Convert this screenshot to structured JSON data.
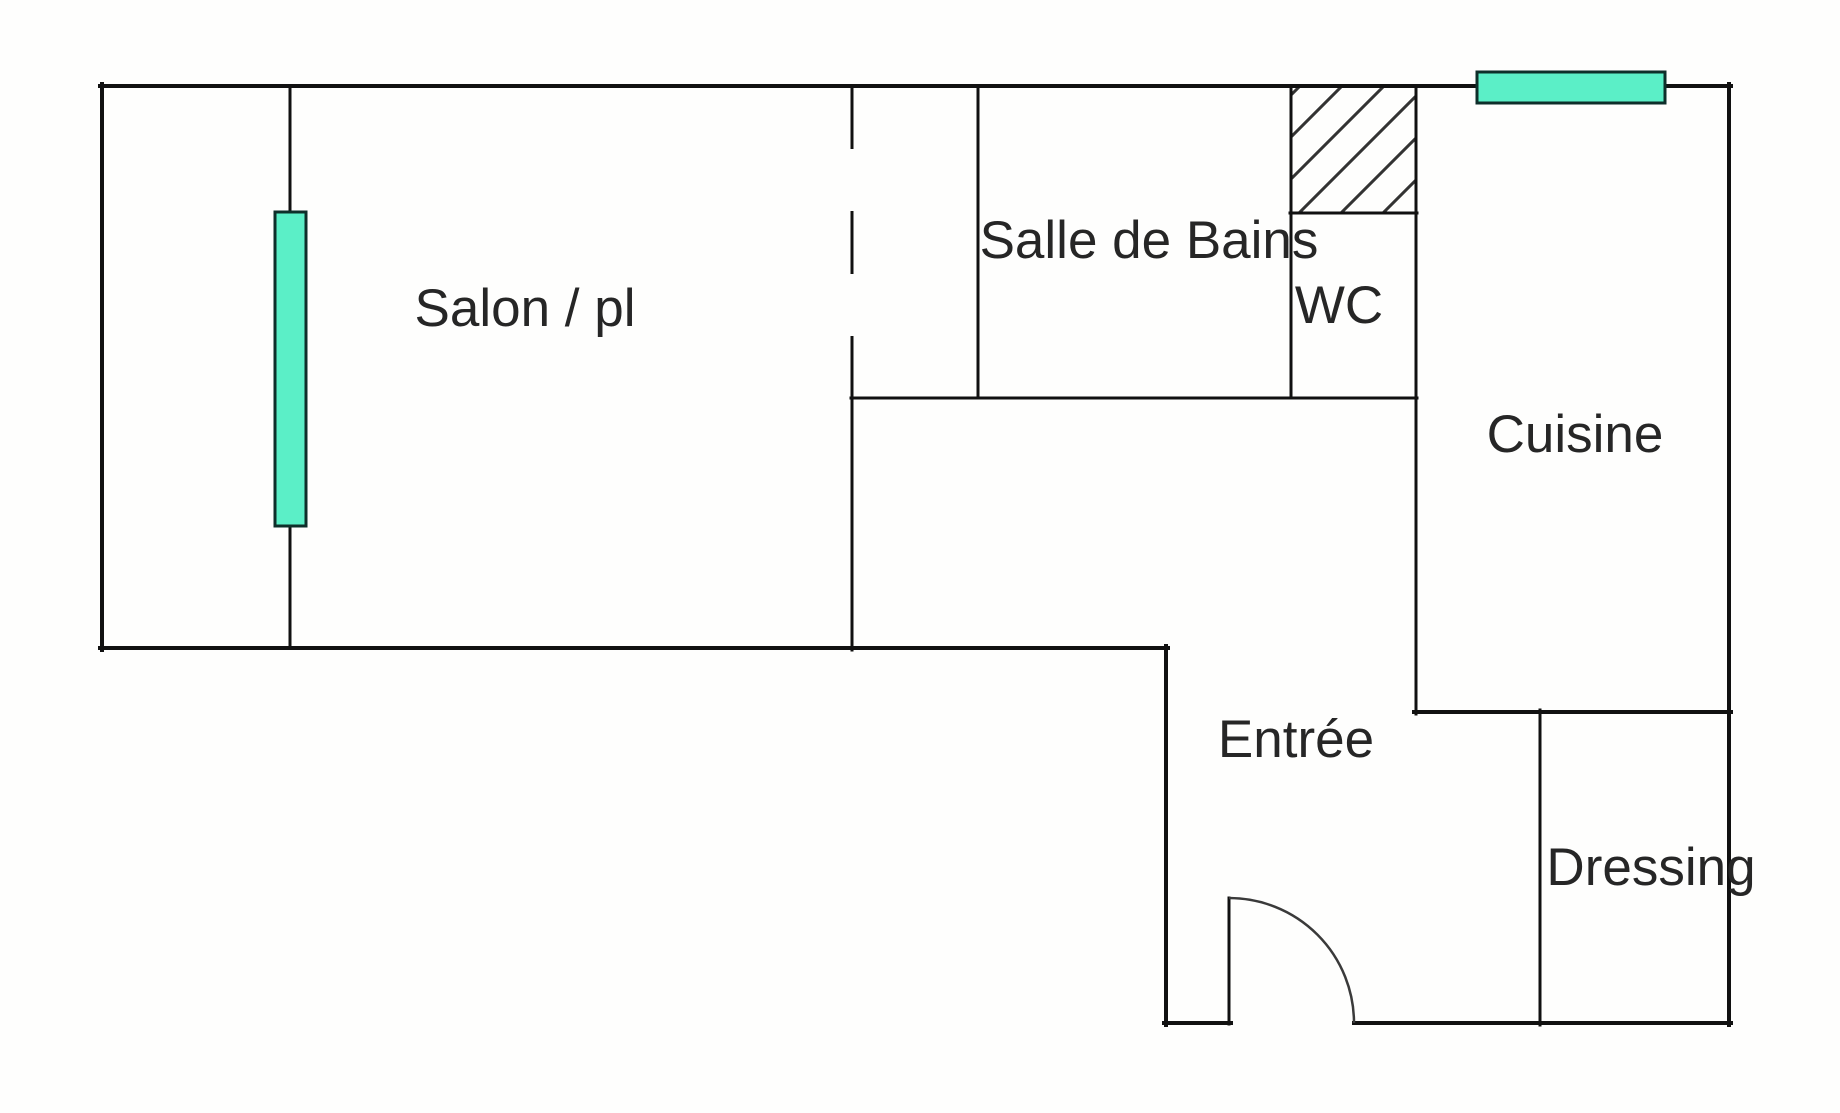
{
  "rooms": {
    "salon": {
      "label": "Salon / pl"
    },
    "salle_de_bains": {
      "label": "Salle de Bains"
    },
    "wc": {
      "label": "WC"
    },
    "cuisine": {
      "label": "Cuisine"
    },
    "entree": {
      "label": "Entrée"
    },
    "dressing": {
      "label": "Dressing"
    }
  },
  "features": {
    "salon_window": "window",
    "cuisine_window": "window",
    "entry_door": "door-with-swing-arc",
    "duct_shaft": "hatched-area"
  },
  "colors": {
    "background": "#fefefd",
    "wall": "#111111",
    "text": "#262626",
    "window-fill": "#5befc7",
    "window-border": "#0e2f2a",
    "hatch": "#333333",
    "arc": "#3a3a3a"
  }
}
